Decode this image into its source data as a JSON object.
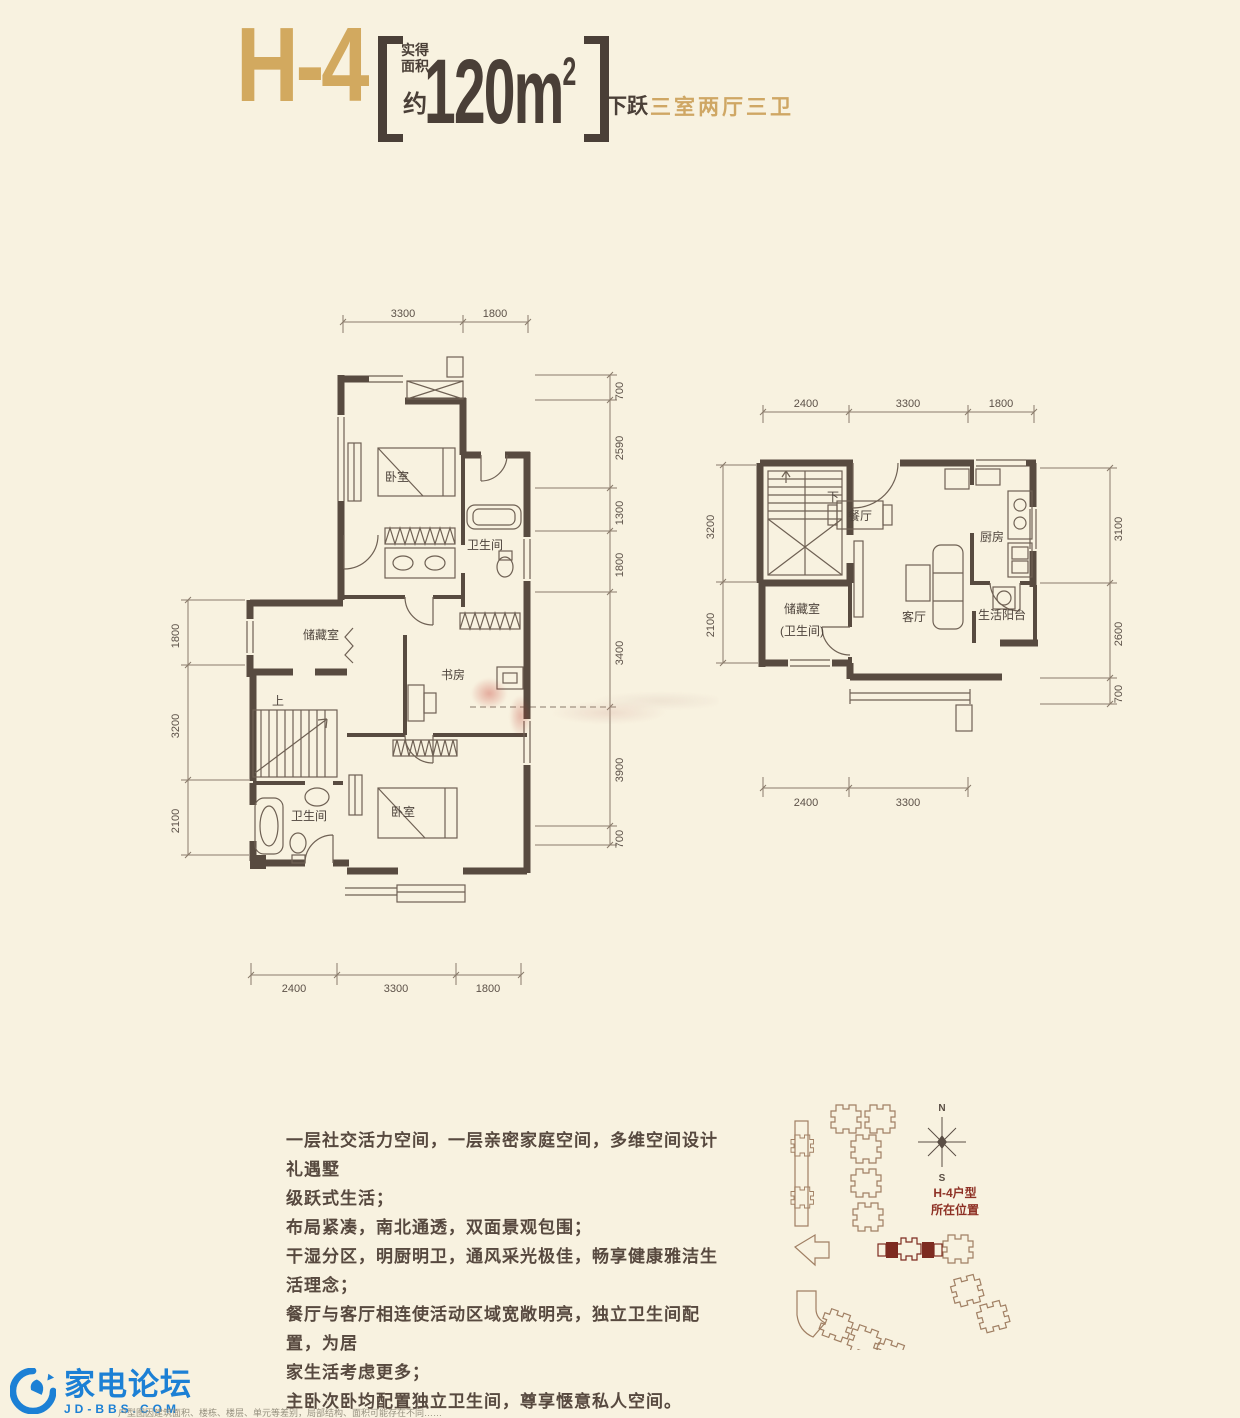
{
  "title": {
    "unit": "H-4",
    "area_label_line1": "实得",
    "area_label_line2": "面积",
    "area_approx": "约",
    "area_value": "120m",
    "area_sup": "2",
    "tag": "下跃",
    "layout": "三室两厅三卫"
  },
  "plan_left": {
    "dims_top": [
      "3300",
      "1800"
    ],
    "dims_bottom": [
      "2400",
      "3300",
      "1800"
    ],
    "dims_left": [
      "1800",
      "3200",
      "2100"
    ],
    "dims_right": [
      "700",
      "2590",
      "1300",
      "1800",
      "3400",
      "3900",
      "700"
    ],
    "rooms": {
      "bedroom_top": "卧室",
      "bath_top": "卫生间",
      "storage": "储藏室",
      "study": "书房",
      "stairs": "上",
      "bath_bottom": "卫生间",
      "bedroom_bottom": "卧室"
    }
  },
  "plan_right": {
    "dims_top": [
      "2400",
      "3300",
      "1800"
    ],
    "dims_bottom": [
      "2400",
      "3300"
    ],
    "dims_left": [
      "3200",
      "2100"
    ],
    "dims_right": [
      "3100",
      "2600",
      "700"
    ],
    "rooms": {
      "stairs": "下",
      "dining": "餐厅",
      "kitchen": "厨房",
      "storage_line1": "储藏室",
      "storage_line2": "(卫生间)",
      "living": "客厅",
      "balcony": "生活阳台"
    }
  },
  "description": {
    "lines": [
      "一层社交活力空间，一层亲密家庭空间，多维空间设计礼遇墅",
      "级跃式生活；",
      "布局紧凑，南北通透，双面景观包围；",
      "干湿分区，明厨明卫，通风采光极佳，畅享健康雅洁生活理念；",
      "餐厅与客厅相连使活动区域宽敞明亮，独立卫生间配置，为居",
      "家生活考虑更多；",
      "主卧次卧均配置独立卫生间，尊享惬意私人空间。"
    ]
  },
  "site_plan": {
    "compass_north": "N",
    "compass_south": "S",
    "label_line1": "H-4户型",
    "label_line2": "所在位置"
  },
  "logo": {
    "brand": "家电论坛",
    "domain": "JD-BBS.COM"
  },
  "footer": {
    "disclaimer": "户型图因建筑面积、楼栋、楼层、单元等差别，局部结构、面积可能存在不同……"
  },
  "colors": {
    "background": "#f8f2e0",
    "gold": "#d2a95f",
    "dark_brown": "#4a3f37",
    "wall": "#584b40",
    "site_red": "#8e3125",
    "logo_blue": "#1c80d5"
  }
}
